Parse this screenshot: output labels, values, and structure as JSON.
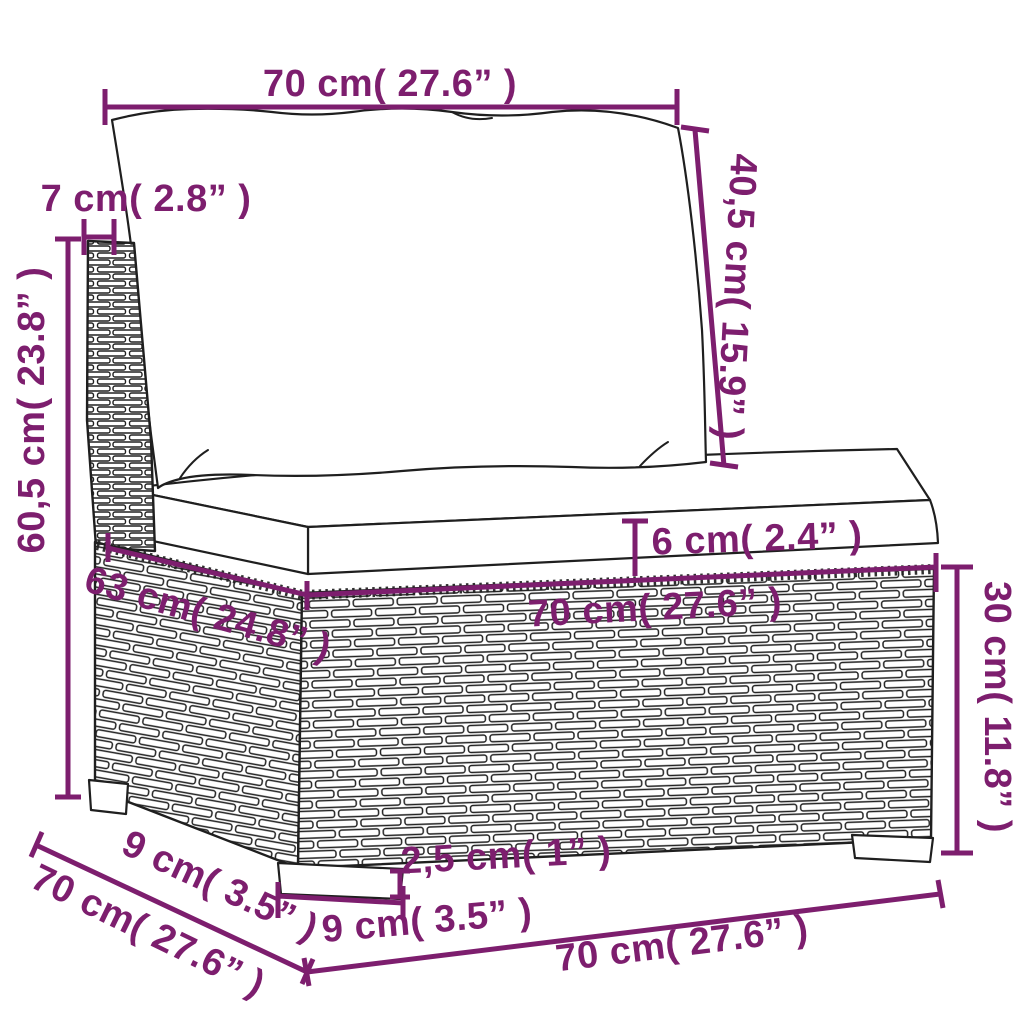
{
  "diagram": {
    "description": "Dimension diagram of a poly rattan garden sofa middle section with back cushion and seat cushion",
    "colors": {
      "accent": "#7d1e6e",
      "ink": "#1f1f1f",
      "background": "#ffffff"
    },
    "labels": [
      {
        "name": "top-width",
        "text": "70 cm( 27.6” )"
      },
      {
        "name": "back-post-depth",
        "text": "7 cm( 2.8” )"
      },
      {
        "name": "back-cushion-height",
        "text": "40,5 cm( 15.9” )"
      },
      {
        "name": "total-height",
        "text": "60,5 cm( 23.8” )"
      },
      {
        "name": "seat-cushion-thickness",
        "text": "6 cm( 2.4” )"
      },
      {
        "name": "seat-depth",
        "text": "63 cm( 24.8” )"
      },
      {
        "name": "seat-width",
        "text": "70 cm( 27.6” )"
      },
      {
        "name": "base-height",
        "text": "30 cm( 11.8” )"
      },
      {
        "name": "foot-height",
        "text": "2,5 cm( 1” )"
      },
      {
        "name": "side-foot-depth",
        "text": "9 cm( 3.5” )"
      },
      {
        "name": "side-depth",
        "text": "70 cm( 27.6” )"
      },
      {
        "name": "front-foot-width",
        "text": "9 cm( 3.5” )"
      },
      {
        "name": "front-width",
        "text": "70 cm( 27.6” )"
      }
    ]
  }
}
